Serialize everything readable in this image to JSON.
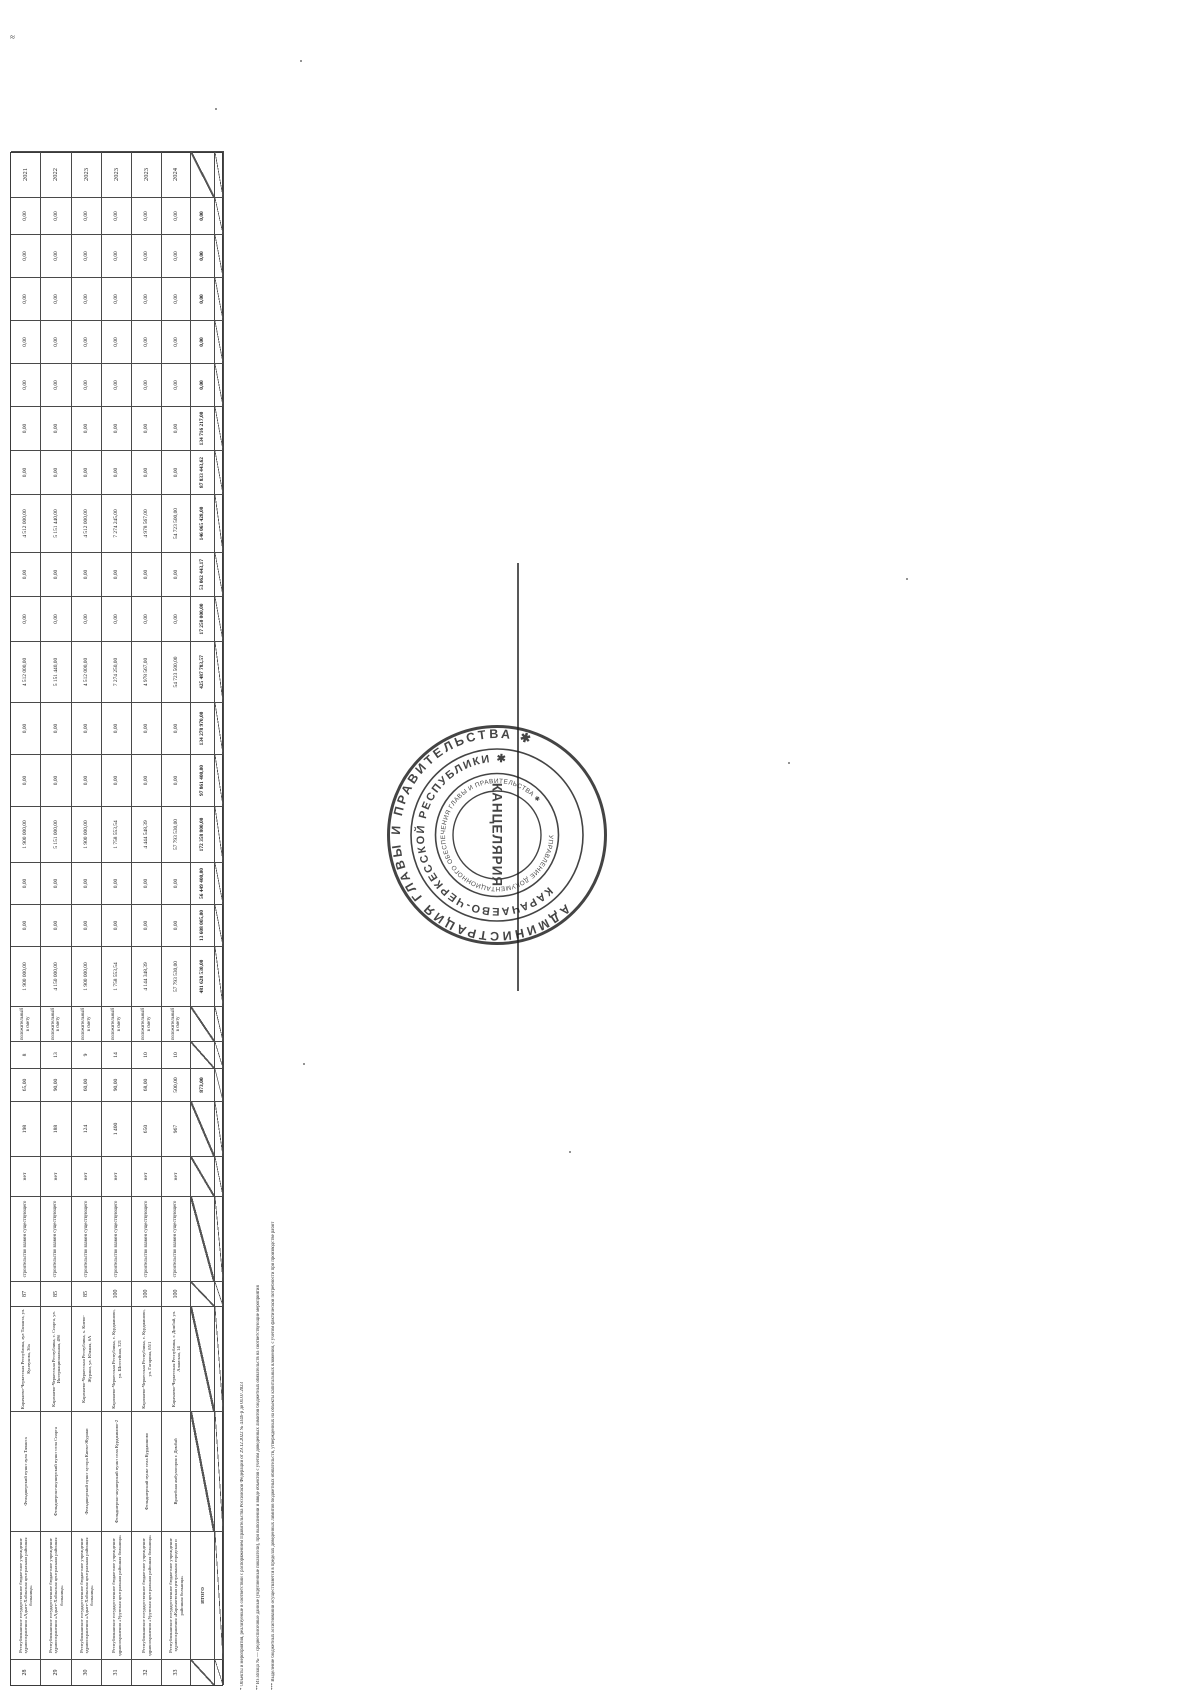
{
  "stamp": {
    "outer_text": "АДМИНИСТРАЦИЯ ГЛАВЫ И ПРАВИТЕЛЬСТВА ✱",
    "middle_text": "КАРАЧАЕВО-ЧЕРКЕССКОЙ РЕСПУБЛИКИ ✱",
    "inner_text": "УПРАВЛЕНИЕ ДОКУМЕНТАЦИОННОГО ОБЕСПЕЧЕНИЯ ГЛАВЫ И ПРАВИТЕЛЬСТВА ✱",
    "center_text": "КАНЦЕЛЯРИЯ",
    "ink_color": "#1c1c1c"
  },
  "corner_mark": "≈",
  "footnotes": [
    "* Объекты и мероприятия, реализуемые в соответствии с распоряжением Правительства Российской Федерации от 29.12.2022 № 4346-р до 01.07.2023",
    "** Из абзаца № — среднесписочные данные (укрупненные показатели), при выполнении и вводе объектов с учетом доведенных лимитов бюджетных обязательств на соответствующие мероприятия",
    "*** Выделение бюджетных ассигнований осуществляется в пределах доведенных лимитов бюджетных обязательств, утвержденных на объекты капитальных вложений, с учетом фактической потребности при производстве работ"
  ],
  "artifact_dots": [
    [
      300,
      60
    ],
    [
      906,
      578
    ],
    [
      788,
      762
    ],
    [
      303,
      1063
    ],
    [
      569,
      1151
    ],
    [
      215,
      108
    ]
  ],
  "table": {
    "col_widths": [
      26,
      128,
      120,
      105,
      25,
      85,
      40,
      55,
      33,
      27,
      35,
      60,
      42,
      42,
      56,
      52,
      52,
      61,
      45,
      44,
      58,
      44,
      44,
      43,
      43,
      43,
      43,
      37,
      46
    ],
    "row_heights": [
      30,
      31,
      30,
      30,
      30,
      29,
      24,
      9
    ],
    "totals_label": "ИТОГО",
    "rows": [
      {
        "cells": [
          "28",
          "Республиканское государственное бюджетное учреждение здравоохранения «Адыге-Хабльская центральная районная больница»",
          "Фельдшерский пункт аула Тапанта",
          "Карачаево-Черкесская Республика, аул Тапанта, ул. Кунчукова, 36а",
          "87",
          "строительство взамен существующего",
          "нет",
          "198",
          "65,00",
          "8",
          "положительный в смету",
          "1 900 000,00",
          "0,00",
          "0,00",
          "1 900 000,00",
          "0,00",
          "0,00",
          "4 512 000,00",
          "0,00",
          "0,00",
          "4 512 000,00",
          "0,00",
          "0,00",
          "0,00",
          "0,00",
          "0,00",
          "0,00",
          "0,00",
          "2021"
        ]
      },
      {
        "cells": [
          "29",
          "Республиканское государственное бюджетное учреждение здравоохранения «Адыге-Хабльская центральная районная больница»",
          "Фельдшерско-акушерский пункт села Спарта",
          "Карачаево-Черкесская Республика, с. Спарта, ул. Интернациональная, 49б",
          "85",
          "строительство взамен существующего",
          "нет",
          "188",
          "90,00",
          "13",
          "положительный в смету",
          "4 150 000,00",
          "0,00",
          "0,00",
          "5 151 000,00",
          "0,00",
          "0,00",
          "5 151 440,00",
          "0,00",
          "0,00",
          "5 151 440,00",
          "0,00",
          "0,00",
          "0,00",
          "0,00",
          "0,00",
          "0,00",
          "0,00",
          "2022"
        ]
      },
      {
        "cells": [
          "30",
          "Республиканское государственное бюджетное учреждение здравоохранения «Адыге-Хабльская центральная районная больница»",
          "Фельдшерский пункт хутора Киево-Жураки",
          "Карачаево-Черкесская Республика, х. Киево-Жураки, ул. Южная, 6А",
          "85",
          "строительство взамен существующего",
          "нет",
          "124",
          "60,00",
          "9",
          "положительный в смету",
          "1 900 000,00",
          "0,00",
          "0,00",
          "1 900 000,00",
          "0,00",
          "0,00",
          "4 512 000,00",
          "0,00",
          "0,00",
          "4 512 000,00",
          "0,00",
          "0,00",
          "0,00",
          "0,00",
          "0,00",
          "0,00",
          "0,00",
          "2023"
        ]
      },
      {
        "cells": [
          "31",
          "Республиканское государственное бюджетное учреждение здравоохранения «Урупская центральная районная больница»",
          "Фельдшерско-акушерский пункт села Курджиново-2",
          "Карачаево-Черкесская Республика, с. Курджиново, ул. Шоссейная, 321",
          "100",
          "строительство взамен существующего",
          "нет",
          "1 400",
          "90,00",
          "14",
          "положительный в смету",
          "1 758 553,54",
          "0,00",
          "0,00",
          "1 758 553,54",
          "0,00",
          "0,00",
          "7 274 250,00",
          "0,00",
          "0,00",
          "7 274 245,00",
          "0,00",
          "0,00",
          "0,00",
          "0,00",
          "0,00",
          "0,00",
          "0,00",
          "2023"
        ]
      },
      {
        "cells": [
          "32",
          "Республиканское государственное бюджетное учреждение здравоохранения «Урупская центральная районная больница»",
          "Фельдшерский пункт села Курджиново",
          "Карачаево-Черкесская Республика, с. Курджиново, ул. Гагарина, 85/1",
          "100",
          "строительство взамен существующего",
          "нет",
          "650",
          "68,00",
          "10",
          "положительный в смету",
          "4 144 348,39",
          "0,00",
          "0,00",
          "4 444 548,39",
          "0,00",
          "0,00",
          "4 978 567,00",
          "0,00",
          "0,00",
          "4 978 567,00",
          "0,00",
          "0,00",
          "0,00",
          "0,00",
          "0,00",
          "0,00",
          "0,00",
          "2023"
        ]
      },
      {
        "cells": [
          "33",
          "Республиканское государственное бюджетное учреждение здравоохранения «Карачаевская центральная городская и районная больница»",
          "Врачебная амбулатория г. Домбай",
          "Карачаево-Черкесская Республика, г. Домбай, ул. Аланская, 14",
          "100",
          "строительство взамен существующего",
          "нет",
          "967",
          "500,00",
          "10",
          "положительный в смету",
          "57 793 530,00",
          "0,00",
          "0,00",
          "57 793 530,00",
          "0,00",
          "0,00",
          "54 723 500,00",
          "0,00",
          "0,00",
          "54 723 500,00",
          "0,00",
          "0,00",
          "0,00",
          "0,00",
          "0,00",
          "0,00",
          "0,00",
          "2024"
        ]
      },
      {
        "cells": [
          "/",
          "ИТОГО",
          "/",
          "/",
          "/",
          "/",
          "/",
          "/",
          "873,00",
          "/",
          "/",
          "481 628 530,00",
          "13 608 005,00",
          "56 449 400,00",
          "172 358 800,00",
          "97 861 400,00",
          "134 278 970,00",
          "425 487 783,57",
          "17 250 000,00",
          "53 062 443,17",
          "146 065 428,00",
          "87 833 443,62",
          "134 716 217,00",
          "0,00",
          "0,00",
          "0,00",
          "0,00",
          "0,00",
          "/"
        ]
      },
      {
        "cells": [
          "/",
          "/",
          "/",
          "/",
          "/",
          "/",
          "/",
          "/",
          "/",
          "/",
          "/",
          "/",
          "/",
          "/",
          "/",
          "/",
          "/",
          "/",
          "/",
          "/",
          "/",
          "/",
          "/",
          "/",
          "/",
          "/",
          "/",
          "/",
          "/"
        ]
      }
    ]
  }
}
